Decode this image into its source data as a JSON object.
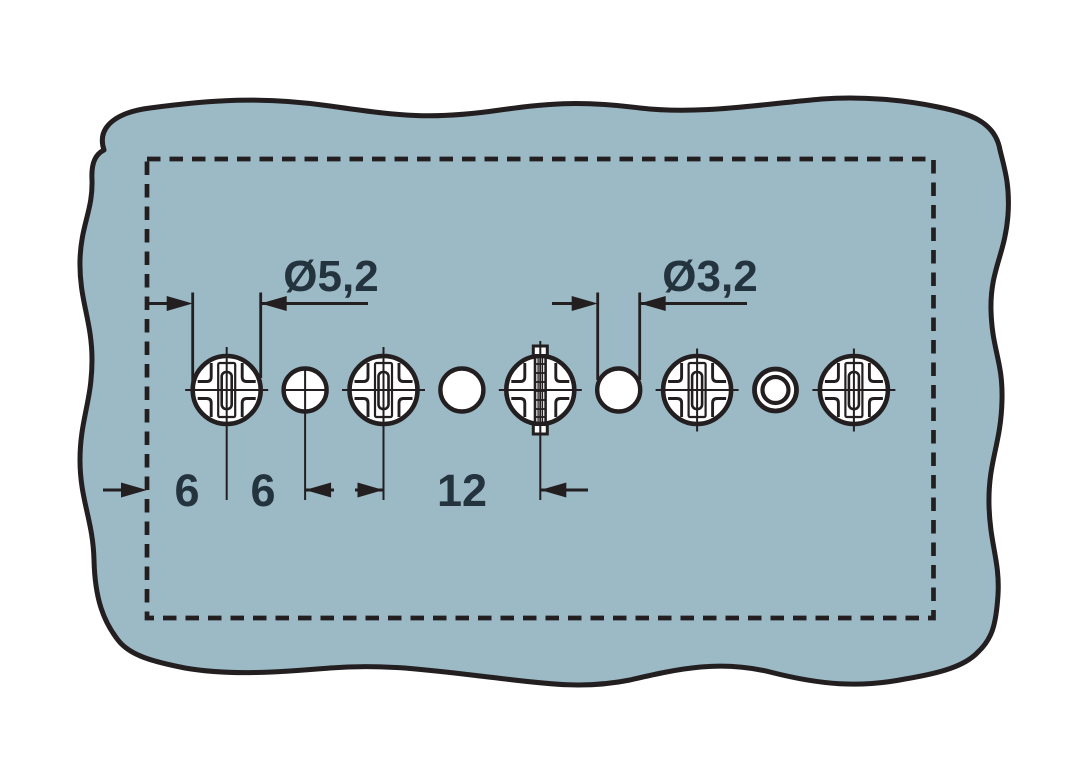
{
  "page": {
    "background": "#ffffff",
    "description": "Drilling template drawing: one horizontal row of screw holes and pilot holes in a panel with dashed mounting outline"
  },
  "colors": {
    "material_fill": "#9cb9c6",
    "line_color": "#231f20",
    "text_color": "#24343f"
  },
  "labels": {
    "diameter_large": "Ø5,2",
    "diameter_small": "Ø3,2",
    "edge_distance": "6",
    "pitch_small": "6",
    "pitch_large": "12"
  },
  "holes": [
    {
      "index": 1,
      "type": "screw-head-cross",
      "diameter_label": "Ø5,2"
    },
    {
      "index": 2,
      "type": "pilot-hole-crosshair",
      "diameter_label": "Ø3,2"
    },
    {
      "index": 3,
      "type": "screw-head-cross",
      "diameter_label": "Ø5,2"
    },
    {
      "index": 4,
      "type": "pilot-hole-plain",
      "diameter_label": "Ø3,2"
    },
    {
      "index": 5,
      "type": "screw-head-with-clamp",
      "diameter_label": "Ø5,2"
    },
    {
      "index": 6,
      "type": "pilot-hole-plain",
      "diameter_label": "Ø3,2"
    },
    {
      "index": 7,
      "type": "screw-head-cross",
      "diameter_label": "Ø5,2"
    },
    {
      "index": 8,
      "type": "sleeve-ring-hole",
      "diameter_label": "Ø3,2"
    },
    {
      "index": 9,
      "type": "screw-head-cross",
      "diameter_label": "Ø5,2"
    }
  ]
}
